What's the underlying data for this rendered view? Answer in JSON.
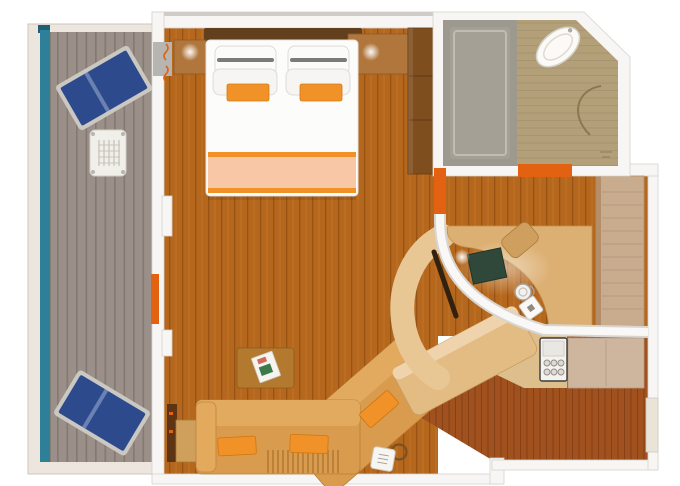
{
  "diagram": {
    "type": "floor-plan",
    "scene": "cruise-stateroom-floor-plan-with-balcony",
    "rooms": {
      "balcony": {
        "name": "balcony",
        "furniture": [
          "lounge-chair",
          "lounge-chair",
          "deck-table"
        ]
      },
      "bedroom": {
        "name": "bedroom",
        "furniture": [
          "double-bed",
          "pillows",
          "accent-pillows",
          "nightstand",
          "nightstand",
          "wardrobe",
          "reading-lights"
        ]
      },
      "living_area": {
        "name": "living-area",
        "furniture": [
          "sectional-sofa",
          "coffee-table",
          "book",
          "side-cabinet",
          "hair-dryer"
        ]
      },
      "desk_nook": {
        "name": "desk-nook",
        "furniture": [
          "curved-desk",
          "stool",
          "desk-blotter",
          "kettle",
          "ice-bucket",
          "desk-lamp",
          "minibar-fridge"
        ]
      },
      "bathroom": {
        "name": "bathroom",
        "furniture": [
          "shower-tub",
          "sink",
          "door-swing"
        ]
      },
      "entry": {
        "name": "entry-hall",
        "furniture": [
          "closet",
          "cabinet",
          "entry-door"
        ]
      }
    },
    "colors": {
      "teal": "#2E8099",
      "deck": "#9A9089",
      "deckline": "#857A71",
      "navy": "#2C4A8C",
      "carpet": "#B4671D",
      "redwood": "#A0511E",
      "wall": "#F7F6F4",
      "walledge": "#D6D3CE",
      "orange": "#E26212",
      "pillow": "#F09228",
      "peach": "#F8C8A6",
      "camel": "#D99C4E",
      "camellight": "#E2AA5E",
      "desk": "#DCAF72",
      "deskband": "#E9C795",
      "wardrobe": "#7E4E1E",
      "woodmid": "#B0763C",
      "closet": "#C9AC8E",
      "cabinet": "#CDB69D",
      "shower": "#9D998F",
      "bathfloor": "#B3A078",
      "green": "#30483A",
      "bedwhite": "#FCFCFB",
      "headboard": "#62401E"
    }
  }
}
